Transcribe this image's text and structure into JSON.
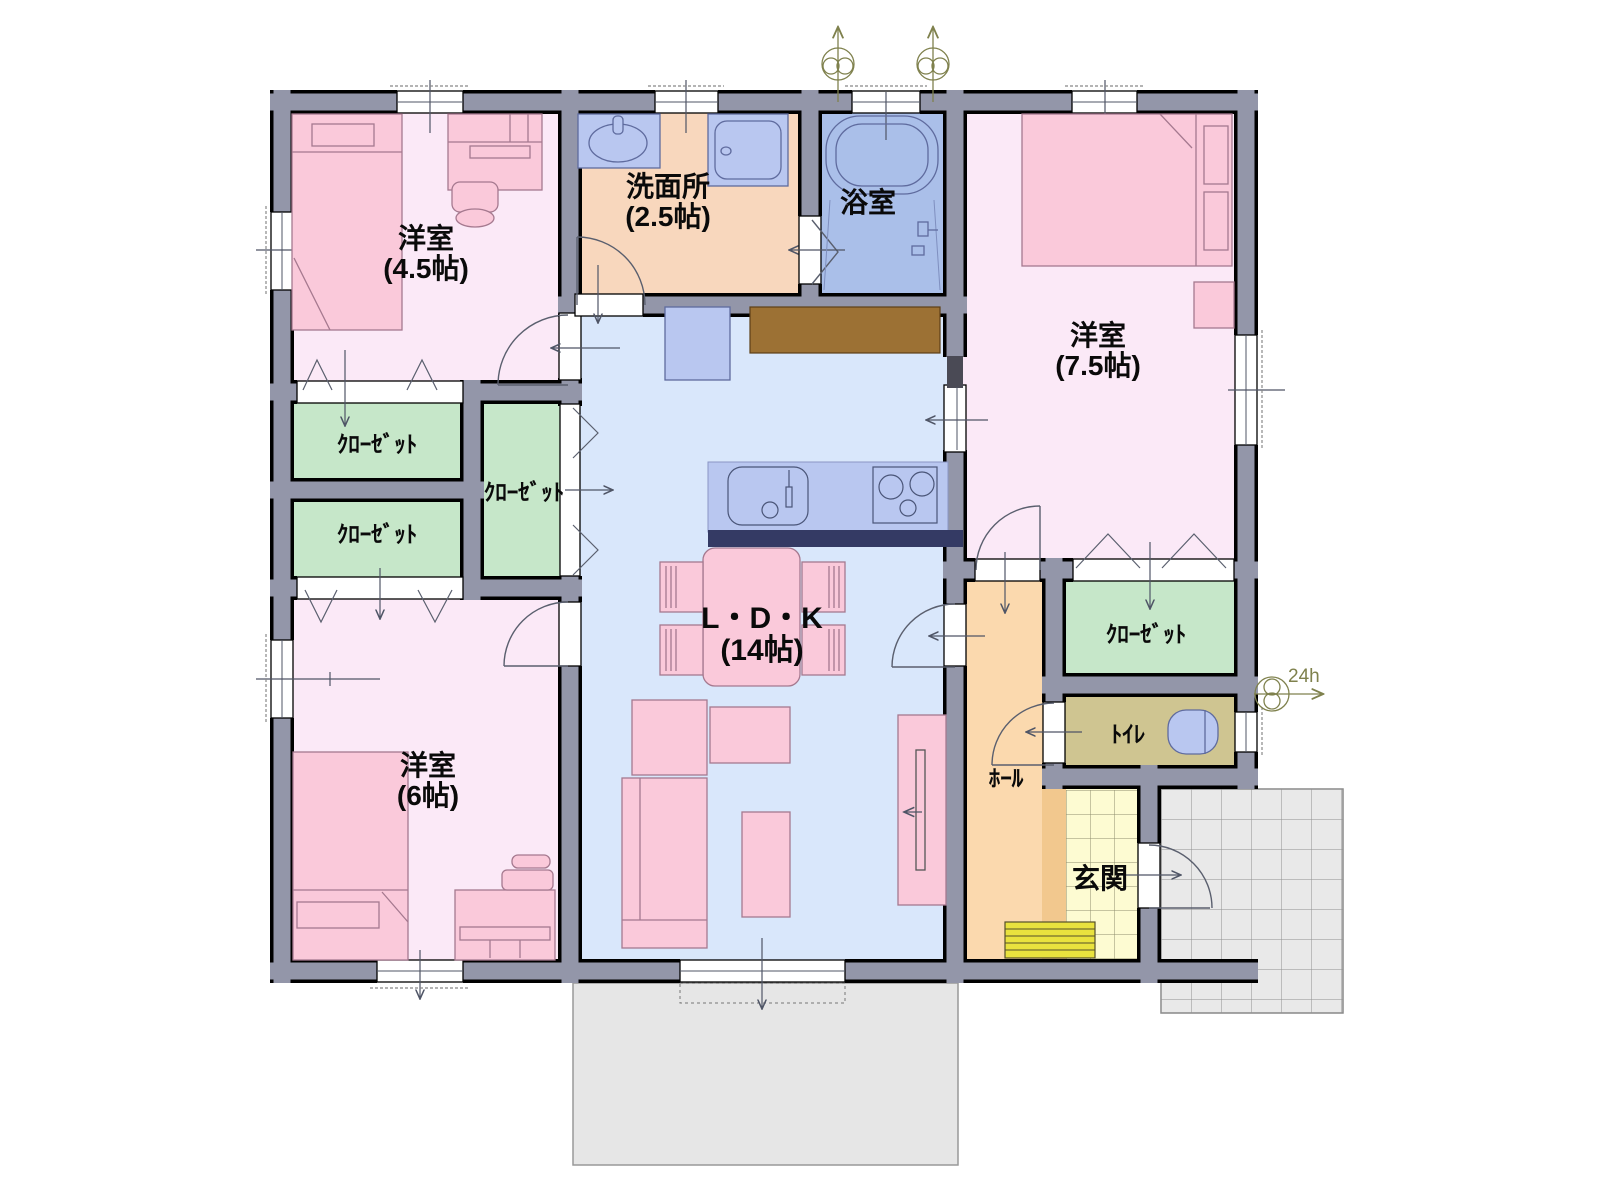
{
  "type": "floor-plan",
  "rooms": {
    "bedroom_4_5": {
      "name": "洋室",
      "size": "(4.5帖)"
    },
    "washroom": {
      "name": "洗面所",
      "size": "(2.5帖)"
    },
    "bathroom": {
      "name": "浴室"
    },
    "bedroom_7_5": {
      "name": "洋室",
      "size": "(7.5帖)"
    },
    "ldk": {
      "name": "L・D・K",
      "size": "(14帖)"
    },
    "bedroom_6": {
      "name": "洋室",
      "size": "(6帖)"
    },
    "closet": {
      "name": "ｸﾛｰｾﾞｯﾄ"
    },
    "toilet": {
      "name": "ﾄｲﾚ"
    },
    "hall": {
      "name": "ﾎｰﾙ"
    },
    "entrance": {
      "name": "玄関"
    }
  },
  "annotations": {
    "ventilation_24h": "24h"
  },
  "palette": {
    "wall": "#9396a9",
    "wall_outline": "#000000",
    "bedroom_floor": "#fbe9f7",
    "ldk_floor": "#d9e7fb",
    "washroom_floor": "#f8d7bd",
    "bathroom_floor": "#aabfe9",
    "closet_floor": "#c6e7c9",
    "toilet_floor": "#cfc591",
    "hall_floor": "#fbd9ae",
    "entrance_floor": "#fdfbd2",
    "porch": "#e9e9e9",
    "deck": "#e6e6e6",
    "furniture_pink": "#fac9da",
    "fixture_blue": "#b9c7f0",
    "counter_bar": "#343a64",
    "cupboard_brown": "#9c7134",
    "shoe_cabinet": "#e9e23e",
    "vent_symbol": "#7f814d"
  }
}
